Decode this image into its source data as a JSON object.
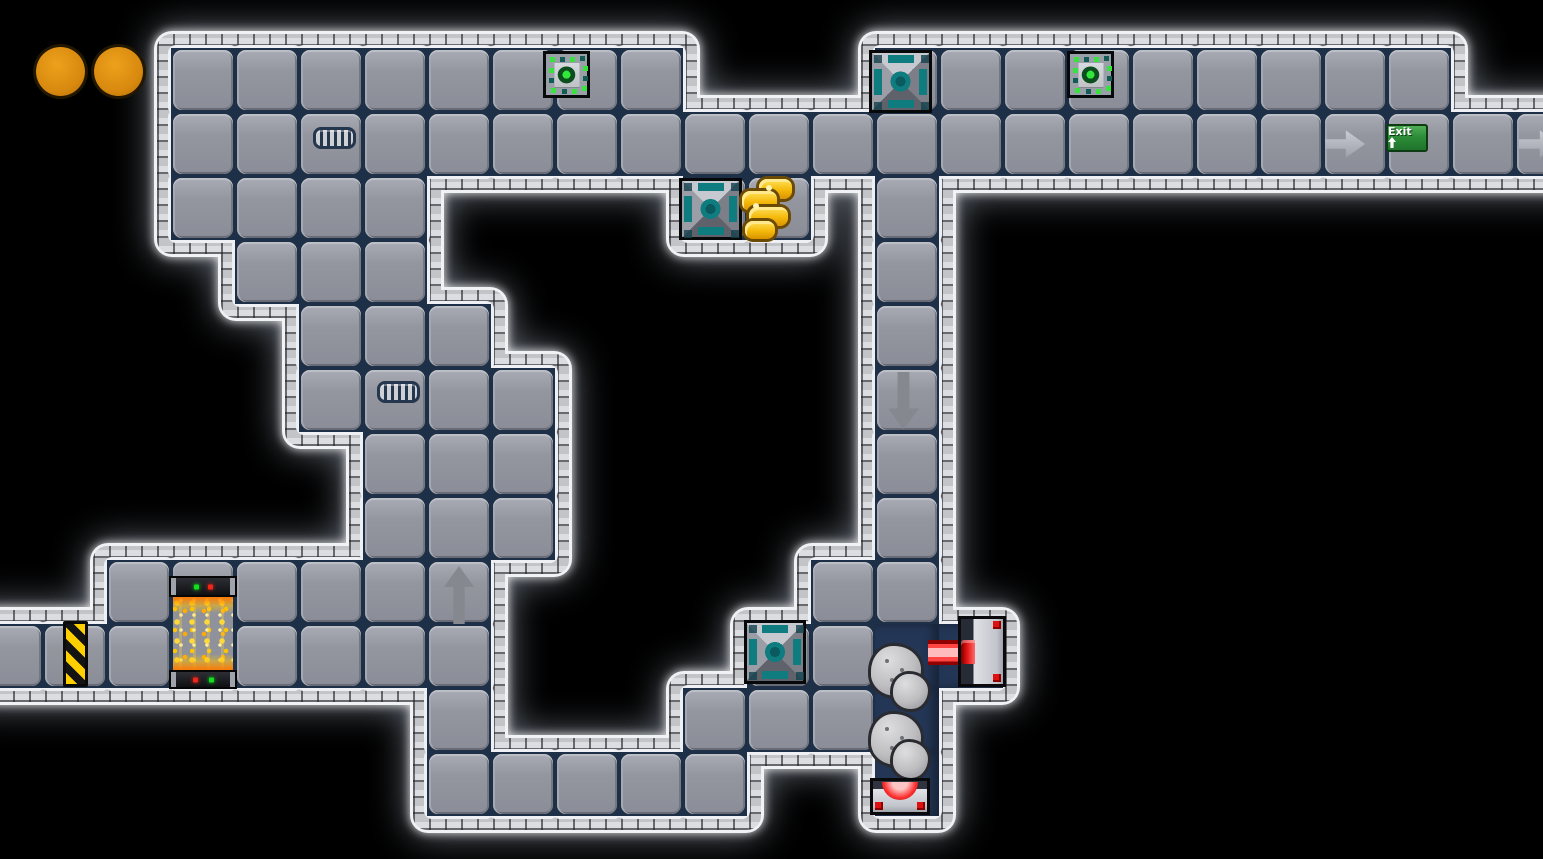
{
  "scene": {
    "background": "#000000",
    "viewport": {
      "width": 1543,
      "height": 859
    },
    "grid": {
      "tile_size": 64,
      "origin_x": -21,
      "origin_y": 48,
      "cols": 25,
      "rows": 12
    },
    "legend": {
      "#": "metal floor tile",
      ".": "void",
      "D": "dark shaft floor"
    },
    "map_rows": [
      "...########...#########..",
      "...######################",
      "...####....##.#..........",
      "....###.......#..........",
      ".....###......#..........",
      ".....####.....#..........",
      "......###.....#..........",
      "......###.....#..........",
      "..######.....##..........",
      "########....##DD.........",
      ".......#...###D..........",
      ".......#####..D.........."
    ],
    "hud": {
      "collected_orb_count": 2,
      "orb_color": "#d8890f"
    },
    "objects": [
      {
        "type": "collectible-dot",
        "x": 36,
        "y": 47,
        "w": 49,
        "h": 49,
        "interactable": false
      },
      {
        "type": "collectible-dot",
        "x": 94,
        "y": 47,
        "w": 49,
        "h": 49,
        "interactable": false
      },
      {
        "type": "sensor-tile",
        "x": 543,
        "y": 51,
        "w": 47,
        "h": 47,
        "interactable": true
      },
      {
        "type": "sensor-tile",
        "x": 1067,
        "y": 51,
        "w": 47,
        "h": 47,
        "interactable": true
      },
      {
        "type": "node-tile",
        "x": 869,
        "y": 50,
        "w": 63,
        "h": 63,
        "interactable": true
      },
      {
        "type": "node-tile",
        "x": 679,
        "y": 178,
        "w": 63,
        "h": 62,
        "interactable": true
      },
      {
        "type": "node-tile",
        "x": 744,
        "y": 620,
        "w": 62,
        "h": 64,
        "interactable": true
      },
      {
        "type": "gold-nugget",
        "x": 740,
        "y": 179,
        "w": 58,
        "h": 61,
        "interactable": true
      },
      {
        "type": "vent-grill",
        "x": 313,
        "y": 127,
        "w": 43,
        "h": 22,
        "interactable": false
      },
      {
        "type": "vent-grill",
        "x": 377,
        "y": 381,
        "w": 43,
        "h": 22,
        "interactable": false
      },
      {
        "type": "arrow-right",
        "x": 1325,
        "y": 129,
        "w": 40,
        "h": 30,
        "interactable": true
      },
      {
        "type": "exit-sign",
        "x": 1386,
        "y": 124,
        "w": 42,
        "h": 28,
        "interactable": true,
        "label": "Exit"
      },
      {
        "type": "arrow-right",
        "x": 1519,
        "y": 129,
        "w": 40,
        "h": 30,
        "interactable": true
      },
      {
        "type": "arrow-up",
        "x": 444,
        "y": 566,
        "w": 30,
        "h": 58,
        "interactable": true
      },
      {
        "type": "arrow-down",
        "x": 888,
        "y": 372,
        "w": 31,
        "h": 57,
        "interactable": true
      },
      {
        "type": "hazard-door",
        "x": 63,
        "y": 621,
        "w": 25,
        "h": 66,
        "interactable": true
      },
      {
        "type": "furnace",
        "x": 169,
        "y": 576,
        "w": 68,
        "h": 113,
        "interactable": false
      },
      {
        "type": "rock",
        "x": 871,
        "y": 646,
        "w": 57,
        "h": 63,
        "interactable": true
      },
      {
        "type": "rock",
        "x": 871,
        "y": 714,
        "w": 57,
        "h": 64,
        "interactable": true
      },
      {
        "type": "laser-beam",
        "x": 928,
        "y": 640,
        "w": 32,
        "h": 25,
        "interactable": false
      },
      {
        "type": "laser-left",
        "x": 958,
        "y": 616,
        "w": 48,
        "h": 71,
        "interactable": true
      },
      {
        "type": "laser-up",
        "x": 870,
        "y": 778,
        "w": 60,
        "h": 37,
        "interactable": true
      }
    ],
    "palette": {
      "floor_tile": "#94969f",
      "tile_gap": "#1d3047",
      "dark_shaft": "#233655",
      "border_brick": "#cdced2",
      "glow": "#ffffff",
      "accent_teal": "#0f7c80",
      "sensor_green": "#38e340",
      "gold": "#f4b90b",
      "hazard_yellow": "#ffd000",
      "laser_red": "#ff4444",
      "exit_green": "#2c8c38",
      "orb_orange": "#d8890f"
    }
  }
}
